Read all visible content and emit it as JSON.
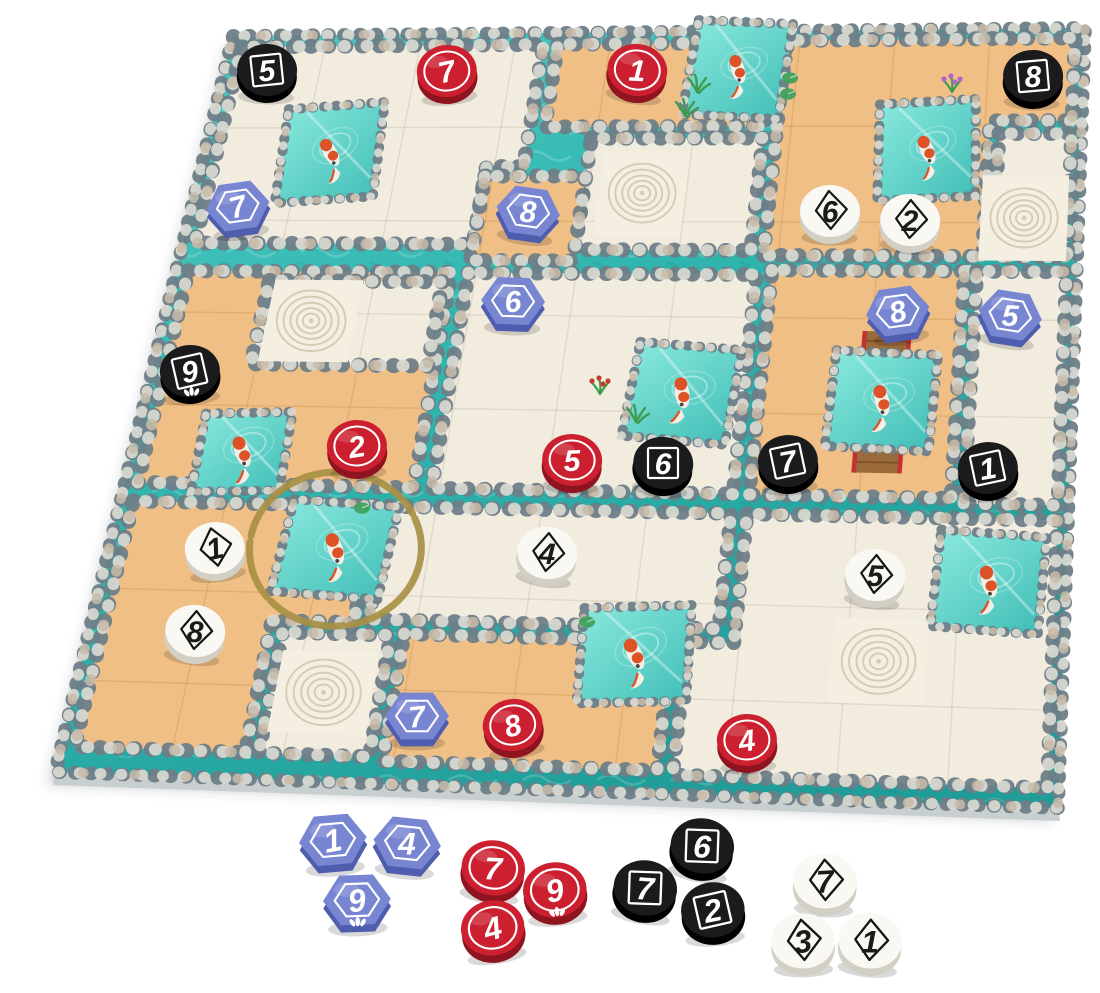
{
  "scene": {
    "width": 1100,
    "height": 993,
    "background": "#ffffff"
  },
  "palette": {
    "water": "#2fb4ae",
    "water_light": "#4fcdc5",
    "water_deep": "#1f9d98",
    "tile_water_a": "#8ceade",
    "tile_water_b": "#3fbdb6",
    "cream": "#f2ecdf",
    "cream_grid": "rgba(120,100,70,0.14)",
    "zen_bg": "#f5efe2",
    "zen_ring": "#d8cbb6",
    "sand": "#f0bf85",
    "sand_grid": "rgba(150,90,20,0.16)",
    "stone_dark": "#6e7e88",
    "stone_light": "#d6d7d0",
    "stone_tan": "#c9bba9",
    "board_side": "#c9ced1",
    "shadow": "rgba(60,70,75,0.28)",
    "gold_ring": "#a89044",
    "token_red": "#cc2030",
    "token_red_side": "#8e1420",
    "token_black": "#1b1b1e",
    "token_black_side": "#000000",
    "token_blue": "#7886d2",
    "token_blue_side": "#4f5dae",
    "token_white": "#faf8f3",
    "token_white_side": "#d2cfc5",
    "ink_dark": "#1a1a1a",
    "ink_light": "#ffffff",
    "koi_orange": "#dd5327",
    "koi_body": "#f3efe6",
    "plant_green": "#3f9b4f",
    "flower_red": "#c43b2e",
    "flower_purple": "#b565c9",
    "pad_green": "#3da05a",
    "bridge_wood": "#9a6a3a",
    "bridge_rail": "#c53030"
  },
  "board": {
    "corners": {
      "tl": [
        233,
        36
      ],
      "tr": [
        1085,
        28
      ],
      "br": [
        1058,
        808
      ],
      "bl": [
        55,
        772
      ]
    },
    "grid": {
      "cols": 9,
      "rows": 8
    },
    "regions": [
      {
        "name": "cream-top-left",
        "fill": "cream",
        "pts": [
          [
            0.12,
            0.12
          ],
          [
            3.3,
            0.12
          ],
          [
            3.3,
            1.42
          ],
          [
            2.92,
            1.42
          ],
          [
            2.92,
            2.25
          ],
          [
            0.12,
            2.25
          ]
        ]
      },
      {
        "name": "sand-top-middle",
        "fill": "sand",
        "pts": [
          [
            3.45,
            0.12
          ],
          [
            5.72,
            0.12
          ],
          [
            5.72,
            1.0
          ],
          [
            3.45,
            1.0
          ]
        ]
      },
      {
        "name": "cream-zen-center-top",
        "fill": "cream",
        "pts": [
          [
            3.95,
            1.12
          ],
          [
            5.72,
            1.12
          ],
          [
            5.72,
            2.3
          ],
          [
            3.95,
            2.3
          ]
        ]
      },
      {
        "name": "sand-small-mid-left",
        "fill": "sand",
        "pts": [
          [
            2.92,
            1.52
          ],
          [
            3.95,
            1.52
          ],
          [
            3.95,
            2.42
          ],
          [
            2.92,
            2.42
          ]
        ]
      },
      {
        "name": "sand-top-right",
        "fill": "sand",
        "pts": [
          [
            5.85,
            0.1
          ],
          [
            8.9,
            0.1
          ],
          [
            8.9,
            0.95
          ],
          [
            8.05,
            0.95
          ],
          [
            8.05,
            2.35
          ],
          [
            5.85,
            2.35
          ]
        ]
      },
      {
        "name": "cream-zen-north-east",
        "fill": "cream",
        "pts": [
          [
            8.15,
            1.08
          ],
          [
            8.9,
            1.08
          ],
          [
            8.9,
            2.35
          ],
          [
            8.15,
            2.35
          ]
        ]
      },
      {
        "name": "sand-left",
        "fill": "sand",
        "pts": [
          [
            0.12,
            2.55
          ],
          [
            2.75,
            2.55
          ],
          [
            2.75,
            4.85
          ],
          [
            0.12,
            4.85
          ]
        ]
      },
      {
        "name": "cream-zen-west",
        "fill": "cream",
        "pts": [
          [
            0.95,
            2.65
          ],
          [
            2.68,
            2.65
          ],
          [
            2.68,
            3.55
          ],
          [
            0.95,
            3.55
          ]
        ]
      },
      {
        "name": "cream-center",
        "fill": "cream",
        "pts": [
          [
            2.92,
            2.55
          ],
          [
            5.8,
            2.55
          ],
          [
            5.8,
            4.85
          ],
          [
            2.92,
            4.85
          ]
        ]
      },
      {
        "name": "sand-right-middle",
        "fill": "sand",
        "pts": [
          [
            5.95,
            2.5
          ],
          [
            7.88,
            2.5
          ],
          [
            7.88,
            4.85
          ],
          [
            5.95,
            4.85
          ]
        ]
      },
      {
        "name": "cream-right-column",
        "fill": "cream",
        "pts": [
          [
            8.0,
            2.5
          ],
          [
            8.9,
            2.5
          ],
          [
            8.9,
            4.9
          ],
          [
            8.0,
            4.9
          ]
        ]
      },
      {
        "name": "sand-bottom-left",
        "fill": "sand",
        "pts": [
          [
            0.12,
            5.05
          ],
          [
            2.42,
            5.05
          ],
          [
            2.42,
            6.3
          ],
          [
            1.66,
            6.3
          ],
          [
            1.66,
            7.72
          ],
          [
            0.12,
            7.72
          ]
        ]
      },
      {
        "name": "cream-zen-south-west",
        "fill": "cream",
        "pts": [
          [
            1.78,
            6.42
          ],
          [
            2.78,
            6.42
          ],
          [
            2.78,
            7.72
          ],
          [
            1.78,
            7.72
          ]
        ]
      },
      {
        "name": "cream-bottom-middle",
        "fill": "cream",
        "pts": [
          [
            2.55,
            5.05
          ],
          [
            5.8,
            5.05
          ],
          [
            5.8,
            6.26
          ],
          [
            2.55,
            6.26
          ]
        ]
      },
      {
        "name": "sand-bottom",
        "fill": "sand",
        "pts": [
          [
            2.9,
            6.4
          ],
          [
            5.38,
            6.4
          ],
          [
            5.38,
            7.76
          ],
          [
            2.9,
            7.76
          ]
        ]
      },
      {
        "name": "cream-bottom-right",
        "fill": "cream",
        "pts": [
          [
            5.95,
            5.05
          ],
          [
            8.9,
            5.05
          ],
          [
            8.9,
            7.8
          ],
          [
            5.52,
            7.8
          ],
          [
            5.52,
            6.4
          ],
          [
            5.95,
            6.4
          ]
        ]
      }
    ],
    "ponds": [
      {
        "id": "koi-1",
        "cx": 1.29,
        "cy": 1.27,
        "h": 0.5,
        "rot": -4,
        "fish_rot": -25,
        "highlight": false,
        "bridge": false
      },
      {
        "id": "koi-2",
        "cx": 5.38,
        "cy": 0.4,
        "h": 0.5,
        "rot": 3,
        "fish_rot": -20,
        "highlight": false,
        "bridge": false
      },
      {
        "id": "koi-3",
        "cx": 7.42,
        "cy": 1.25,
        "h": 0.5,
        "rot": -3,
        "fish_rot": -20,
        "highlight": false,
        "bridge": false
      },
      {
        "id": "koi-4",
        "cx": 5.2,
        "cy": 3.8,
        "h": 0.5,
        "rot": 4,
        "fish_rot": -12,
        "highlight": false,
        "bridge": false
      },
      {
        "id": "koi-5",
        "cx": 1.05,
        "cy": 4.5,
        "h": 0.42,
        "rot": -2,
        "fish_rot": -18,
        "highlight": false,
        "bridge": false
      },
      {
        "id": "koi-6",
        "cx": 2.12,
        "cy": 5.52,
        "h": 0.5,
        "rot": 3,
        "fish_rot": -22,
        "highlight": true,
        "bridge": false
      },
      {
        "id": "koi-7",
        "cx": 7.15,
        "cy": 3.85,
        "h": 0.5,
        "rot": 2,
        "fish_rot": -15,
        "highlight": false,
        "bridge": true
      },
      {
        "id": "koi-8",
        "cx": 5.05,
        "cy": 6.55,
        "h": 0.5,
        "rot": -3,
        "fish_rot": -22,
        "highlight": false,
        "bridge": false
      },
      {
        "id": "koi-9",
        "cx": 8.28,
        "cy": 5.7,
        "h": 0.5,
        "rot": 3,
        "fish_rot": -18,
        "highlight": false,
        "bridge": false
      }
    ],
    "zen_tiles": [
      {
        "cx": 4.55,
        "cy": 1.7
      },
      {
        "cx": 8.45,
        "cy": 1.95
      },
      {
        "cx": 1.45,
        "cy": 3.08
      },
      {
        "cx": 2.26,
        "cy": 7.05
      },
      {
        "cx": 7.3,
        "cy": 6.55
      }
    ],
    "plants": [
      {
        "x": 697,
        "y": 92,
        "kind": "grass"
      },
      {
        "x": 685,
        "y": 116,
        "kind": "grass"
      },
      {
        "x": 952,
        "y": 92,
        "kind": "flower"
      },
      {
        "x": 790,
        "y": 78,
        "kind": "pad"
      },
      {
        "x": 788,
        "y": 94,
        "kind": "pad"
      },
      {
        "x": 600,
        "y": 394,
        "kind": "flower-red"
      },
      {
        "x": 636,
        "y": 422,
        "kind": "grass"
      },
      {
        "x": 362,
        "y": 508,
        "kind": "pad"
      },
      {
        "x": 587,
        "y": 622,
        "kind": "pad"
      }
    ]
  },
  "tokens": {
    "shape_by_color": {
      "red": "circle-ring",
      "black": "square-outline",
      "blue": "hexagon-outline",
      "white": "diamond-outline"
    },
    "on_board": [
      {
        "color": "black",
        "value": "5",
        "x": 267,
        "y": 72,
        "lotus": false
      },
      {
        "color": "red",
        "value": "7",
        "x": 447,
        "y": 73,
        "lotus": false
      },
      {
        "color": "red",
        "value": "1",
        "x": 637,
        "y": 72,
        "lotus": false
      },
      {
        "color": "black",
        "value": "8",
        "x": 1033,
        "y": 78,
        "lotus": false
      },
      {
        "color": "blue",
        "value": "7",
        "x": 238,
        "y": 208,
        "lotus": false
      },
      {
        "color": "blue",
        "value": "8",
        "x": 528,
        "y": 213,
        "lotus": false
      },
      {
        "color": "white",
        "value": "6",
        "x": 830,
        "y": 213,
        "lotus": false
      },
      {
        "color": "white",
        "value": "2",
        "x": 910,
        "y": 222,
        "lotus": false
      },
      {
        "color": "blue",
        "value": "6",
        "x": 513,
        "y": 303,
        "lotus": false
      },
      {
        "color": "blue",
        "value": "8",
        "x": 898,
        "y": 313,
        "lotus": false
      },
      {
        "color": "blue",
        "value": "5",
        "x": 1010,
        "y": 317,
        "lotus": false
      },
      {
        "color": "black",
        "value": "9",
        "x": 190,
        "y": 373,
        "lotus": true
      },
      {
        "color": "red",
        "value": "2",
        "x": 357,
        "y": 448,
        "lotus": false
      },
      {
        "color": "red",
        "value": "5",
        "x": 572,
        "y": 462,
        "lotus": false
      },
      {
        "color": "black",
        "value": "6",
        "x": 663,
        "y": 465,
        "lotus": false
      },
      {
        "color": "black",
        "value": "7",
        "x": 788,
        "y": 463,
        "lotus": false
      },
      {
        "color": "black",
        "value": "1",
        "x": 988,
        "y": 470,
        "lotus": false
      },
      {
        "color": "white",
        "value": "1",
        "x": 215,
        "y": 550,
        "lotus": false
      },
      {
        "color": "white",
        "value": "4",
        "x": 547,
        "y": 555,
        "lotus": false
      },
      {
        "color": "white",
        "value": "5",
        "x": 875,
        "y": 577,
        "lotus": false
      },
      {
        "color": "white",
        "value": "8",
        "x": 195,
        "y": 633,
        "lotus": false
      },
      {
        "color": "blue",
        "value": "7",
        "x": 417,
        "y": 718,
        "lotus": false
      },
      {
        "color": "red",
        "value": "8",
        "x": 513,
        "y": 727,
        "lotus": false
      },
      {
        "color": "red",
        "value": "4",
        "x": 747,
        "y": 742,
        "lotus": false
      }
    ],
    "tray": [
      {
        "group": "blue",
        "color": "blue",
        "value": "1",
        "x": 333,
        "y": 842,
        "lotus": false
      },
      {
        "group": "blue",
        "color": "blue",
        "value": "4",
        "x": 407,
        "y": 845,
        "lotus": false
      },
      {
        "group": "blue",
        "color": "blue",
        "value": "9",
        "x": 357,
        "y": 902,
        "lotus": true
      },
      {
        "group": "red",
        "color": "red",
        "value": "7",
        "x": 493,
        "y": 870,
        "lotus": false
      },
      {
        "group": "red",
        "color": "red",
        "value": "9",
        "x": 555,
        "y": 892,
        "lotus": true
      },
      {
        "group": "red",
        "color": "red",
        "value": "4",
        "x": 493,
        "y": 930,
        "lotus": false
      },
      {
        "group": "black",
        "color": "black",
        "value": "6",
        "x": 702,
        "y": 848,
        "lotus": false
      },
      {
        "group": "black",
        "color": "black",
        "value": "7",
        "x": 645,
        "y": 890,
        "lotus": false
      },
      {
        "group": "black",
        "color": "black",
        "value": "2",
        "x": 713,
        "y": 912,
        "lotus": false
      },
      {
        "group": "white",
        "color": "white",
        "value": "7",
        "x": 825,
        "y": 883,
        "lotus": false
      },
      {
        "group": "white",
        "color": "white",
        "value": "3",
        "x": 803,
        "y": 943,
        "lotus": false
      },
      {
        "group": "white",
        "color": "white",
        "value": "1",
        "x": 870,
        "y": 943,
        "lotus": false
      }
    ]
  }
}
